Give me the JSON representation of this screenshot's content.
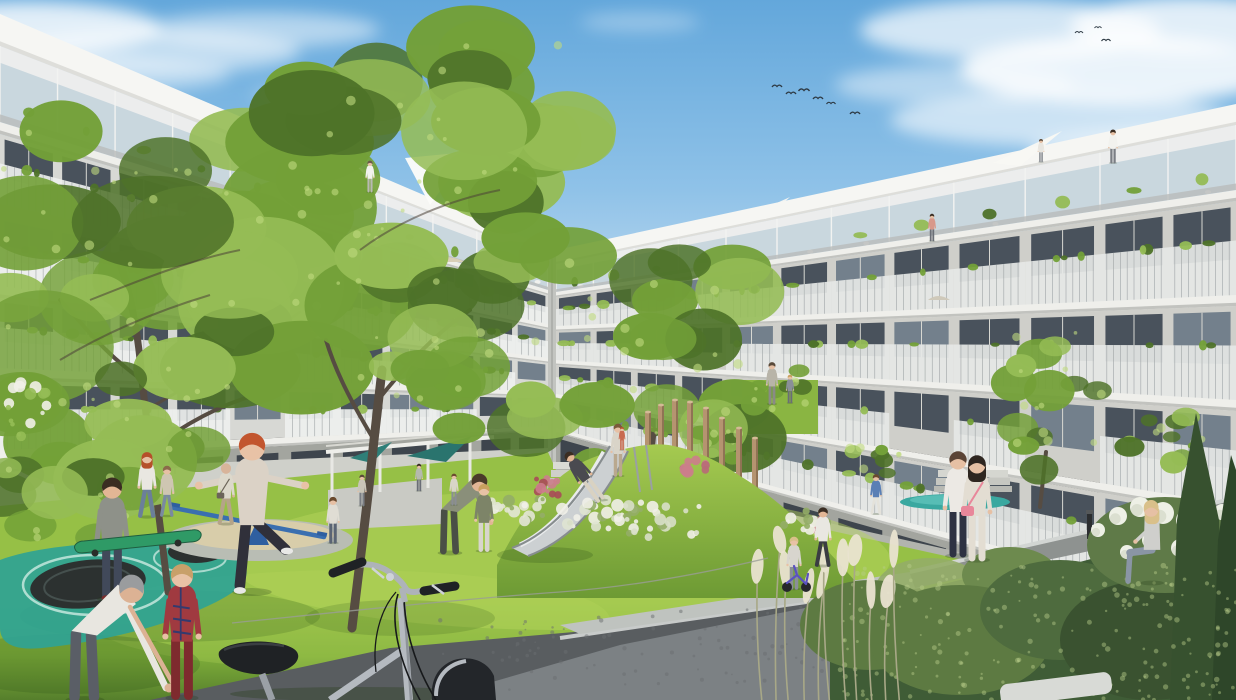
{
  "meta": {
    "scene_description": "Architectural rendering of a new-build apartment complex courtyard: two white balcony-lined residential wings around a sunny lawn with playground slide mound, trampoline, seesaw, climbing poles, pergola with teal shade sails, residents and children playing, and a bicycle in the foreground"
  },
  "palette": {
    "sky_top": "#63a7db",
    "sky_mid": "#8fc2e8",
    "sky_horizon": "#d9e9f5",
    "cloud": "#ffffff",
    "parapet": "#f6f6f3",
    "slab": "#efefeb",
    "facade_left": "#e9eae6",
    "facade_left_shadow": "#d7d8d4",
    "facade_right": "#e3e3df",
    "facade_right_shadow": "#cfcfca",
    "facade_base": "#a3a59f",
    "corner_shade": "#c2c4c0",
    "window": "#49525c",
    "window_light": "#73808c",
    "mullion": "#d8d8d2",
    "railing_light": "#eef0ee",
    "railing_dark": "#9aa0a2",
    "balcony_underside": "#8d9294",
    "glass": "#c9d7de",
    "terrace": "#cfd0ca",
    "step": "#dadbd5",
    "lawn_bright": "#aacd52",
    "lawn_mid": "#85b43e",
    "lawn_dark": "#527e2b",
    "lawn_back": "#8ab542",
    "lawn_shadow": "#2e5418",
    "tree_dark": "#4e7229",
    "tree_mid": "#73a038",
    "tree_light": "#95bc55",
    "tree_highlight": "#c0da7e",
    "trunk": "#564c42",
    "sand": "#d8cdaa",
    "gravel": "#b9bdb4",
    "slide_metal": "#ccd0d2",
    "slide_light": "#e9ebec",
    "slide_edge": "#878d8f",
    "wood": "#b59470",
    "wood_shadow": "#8f7354",
    "teal_canopy": "#2f7f78",
    "teal_ground": "#2fa394",
    "teal_ring": "#d8f0e8",
    "pool": "#3aa8a0",
    "seesaw": "#3a6fb0",
    "seesaw_dark": "#2f5fa0",
    "path": "#595d60",
    "walkway": "#bfc3bf",
    "wall_face": "#7c8184",
    "wall_cap": "#cfd2d2",
    "wall_speckle": "#6a6e70",
    "bush_dark": "#3f5c36",
    "bush_mid": "#5d7a42",
    "bush_light": "#94ad67",
    "conifer": "#37512f",
    "hydrangea": "#eef0e6",
    "pampas": "#e9e3d0",
    "pampas_stem": "#a8a887",
    "flower_white": "#f1f0e8",
    "flower_pink": "#cc7d8c",
    "flower_red": "#a84b58",
    "bike_frame": "#b5bac0",
    "bike_frame_dark": "#8e9399",
    "bike_black": "#1f2225",
    "skate_green": "#2f9a66",
    "trike_blue": "#5a52c0",
    "bird": "#2e3a44",
    "fence_white": "#f2f3f0",
    "umbrella_gray": "#909494",
    "bollard": "#2c2e30",
    "lounger": "#d8dad6"
  },
  "sky": {
    "birds": [
      {
        "x": 777,
        "y": 87,
        "s": 1.0
      },
      {
        "x": 791,
        "y": 94,
        "s": 1.0
      },
      {
        "x": 804,
        "y": 91,
        "s": 1.1
      },
      {
        "x": 818,
        "y": 99,
        "s": 1.0
      },
      {
        "x": 831,
        "y": 104,
        "s": 0.9
      },
      {
        "x": 855,
        "y": 114,
        "s": 1.0
      },
      {
        "x": 1079,
        "y": 33,
        "s": 0.8
      },
      {
        "x": 1098,
        "y": 28,
        "s": 0.7
      },
      {
        "x": 1106,
        "y": 41,
        "s": 0.9
      }
    ]
  },
  "figures": [
    {
      "name": "woman-red-hair",
      "pose": "walk",
      "x": 147,
      "feet": 517,
      "h": 62,
      "hair": "#b5502a",
      "skin": "#e6c0a4",
      "top": "#e9e7e1",
      "bottom": "#6b7f9a",
      "longhair": true
    },
    {
      "name": "teen-walking",
      "pose": "walk",
      "x": 167,
      "feet": 516,
      "h": 48,
      "hair": "#8a6a4a",
      "skin": "#e6c0a4",
      "top": "#cfc6b2",
      "bottom": "#7a8aa0"
    },
    {
      "name": "boy-with-skateboard",
      "pose": "stand",
      "x": 112,
      "feet": 599,
      "h": 116,
      "hair": "#3a2d22",
      "skin": "#e2b695",
      "top": "#8e9189",
      "bottom": "#41495a",
      "shoes": "#7a2e2e"
    },
    {
      "name": "girl-jumping-trampoline",
      "pose": "jump",
      "x": 252,
      "feet": 592,
      "h": 152,
      "hair": "#c2552e",
      "skin": "#e8c2a6",
      "top": "#dbd2c6",
      "bottom": "#30303a",
      "shoes": "#e8e8e6"
    },
    {
      "name": "grandfather-bending",
      "pose": "bend",
      "x": 85,
      "feet": 700,
      "h": 150,
      "hair": "#9a9c9e",
      "skin": "#dcb294",
      "top": "#e8e6e0",
      "bottom": "#5a5e66",
      "reach": true
    },
    {
      "name": "boy-plaid-shirt",
      "pose": "stand",
      "x": 182,
      "feet": 698,
      "h": 128,
      "hair": "#c8a06a",
      "skin": "#e8c2a6",
      "top": "#a03a40",
      "bottom": "#7e2a2e",
      "plaid": true
    },
    {
      "name": "man-shoulder-bag",
      "pose": "walk",
      "x": 226,
      "feet": 524,
      "h": 58,
      "hair": "#d8b49a",
      "skin": "#d8b49a",
      "top": "#dcd8cb",
      "bottom": "#b5a488",
      "bag": "#6b6458"
    },
    {
      "name": "child-at-seesaw",
      "pose": "stand",
      "x": 333,
      "feet": 543,
      "h": 44,
      "hair": "#6a4a2e",
      "skin": "#e6c0a4",
      "top": "#e0ddd4",
      "bottom": "#5a6474"
    },
    {
      "name": "parent-playing",
      "pose": "bend",
      "x": 450,
      "feet": 553,
      "h": 95,
      "hair": "#4a3a2a",
      "skin": "#e2b695",
      "top": "#8a8f7a",
      "bottom": "#4a4f46"
    },
    {
      "name": "child-green-jacket",
      "pose": "stand",
      "x": 484,
      "feet": 551,
      "h": 64,
      "hair": "#c9a05f",
      "skin": "#e8c2a6",
      "top": "#7d8468",
      "bottom": "#d8d5cc"
    },
    {
      "name": "mother-on-slide-mound",
      "pose": "stand",
      "x": 618,
      "feet": 476,
      "h": 50,
      "hair": "#7a5a3a",
      "skin": "#e6c0a4",
      "top": "#d9d4c8",
      "bottom": "#b9a88e"
    },
    {
      "name": "toddler-carried",
      "pose": "stand",
      "x": 622,
      "feet": 450,
      "h": 22,
      "hair": "#b5502a",
      "skin": "#e8c2a6",
      "top": "#c86a50",
      "bottom": "#c86a50"
    },
    {
      "name": "child-sliding",
      "pose": "slide",
      "x": 601,
      "feet": 500,
      "h": 56,
      "hair": "#3a2d22",
      "skin": "#e2b695",
      "top": "#4a4a50",
      "bottom": "#d9d2c2"
    },
    {
      "name": "resident-recess-adult",
      "pose": "stand",
      "x": 772,
      "feet": 404,
      "h": 40,
      "hair": "#5a4a3a",
      "skin": "#e6c0a4",
      "top": "#b8b4a8",
      "bottom": "#8a8a86"
    },
    {
      "name": "resident-recess-child",
      "pose": "stand",
      "x": 790,
      "feet": 403,
      "h": 27,
      "hair": "#c9a05f",
      "skin": "#e8c2a6",
      "top": "#8a8f98",
      "bottom": "#6a6e76"
    },
    {
      "name": "boy-blue-top",
      "pose": "walk",
      "x": 876,
      "feet": 514,
      "h": 38,
      "hair": "#6a4a2e",
      "skin": "#e6c0a4",
      "top": "#5a7fb5",
      "bottom": "#e4e2da"
    },
    {
      "name": "toddler-balance-bike",
      "pose": "stand",
      "x": 794,
      "feet": 589,
      "h": 50,
      "hair": "#d9c08a",
      "skin": "#e8c2a6",
      "top": "#d8d5ce",
      "bottom": "#8a8f98"
    },
    {
      "name": "boy-white-tee",
      "pose": "walk",
      "x": 823,
      "feet": 566,
      "h": 56,
      "hair": "#3a2d22",
      "skin": "#e2b695",
      "top": "#e9e7e1",
      "bottom": "#3a3d42"
    },
    {
      "name": "woman-white-blouse",
      "pose": "stand",
      "x": 958,
      "feet": 556,
      "h": 100,
      "hair": "#5a4436",
      "skin": "#e6c0a4",
      "top": "#ece9e4",
      "bottom": "#2e3242"
    },
    {
      "name": "woman-pink-bag",
      "pose": "stand",
      "x": 977,
      "feet": 560,
      "h": 100,
      "hair": "#2e2620",
      "skin": "#e6c0a4",
      "top": "#e3ddd2",
      "bottom": "#e3ddd2",
      "longhair": true,
      "bag": "#e8879a"
    },
    {
      "name": "woman-seated",
      "pose": "sit",
      "x": 1152,
      "feet": 583,
      "h": 92,
      "hair": "#d9c08a",
      "skin": "#e6c0a4",
      "top": "#cfcfcc",
      "bottom": "#8a95a5",
      "longhair": true
    },
    {
      "name": "resident-penthouse-left",
      "pose": "stand",
      "x": 370,
      "feet": 192,
      "h": 30,
      "hair": "#6a5a4a",
      "skin": "#e6c0a4",
      "top": "#f2f2ee",
      "bottom": "#b9b9b2"
    },
    {
      "name": "resident-penthouse-right",
      "pose": "stand",
      "x": 1113,
      "feet": 163,
      "h": 32,
      "hair": "#3a2d22",
      "skin": "#e6c0a4",
      "top": "#f2f2ee",
      "bottom": "#7a7e84"
    },
    {
      "name": "resident-balcony",
      "pose": "stand",
      "x": 932,
      "feet": 241,
      "h": 26,
      "hair": "#3a2d22",
      "skin": "#e6c0a4",
      "top": "#d8988a",
      "bottom": "#6a6e76"
    },
    {
      "name": "resident-terrace",
      "pose": "stand",
      "x": 1041,
      "feet": 162,
      "h": 22,
      "hair": "#5a4a3a",
      "skin": "#e6c0a4",
      "top": "#e8e6e0",
      "bottom": "#8a8e94"
    },
    {
      "name": "resident-pergola-a",
      "pose": "stand",
      "x": 362,
      "feet": 506,
      "h": 30,
      "hair": "#5a4a3a",
      "skin": "#e6c0a4",
      "top": "#c9c5b8",
      "bottom": "#7a7e84"
    },
    {
      "name": "resident-pergola-b",
      "pose": "stand",
      "x": 419,
      "feet": 491,
      "h": 26,
      "hair": "#3a2d22",
      "skin": "#e6c0a4",
      "top": "#b5b9ae",
      "bottom": "#6a6e76"
    },
    {
      "name": "resident-pergola-c",
      "pose": "stand",
      "x": 454,
      "feet": 505,
      "h": 30,
      "hair": "#6a4a2e",
      "skin": "#e6c0a4",
      "top": "#d8d5c8",
      "bottom": "#8a8e94"
    }
  ]
}
